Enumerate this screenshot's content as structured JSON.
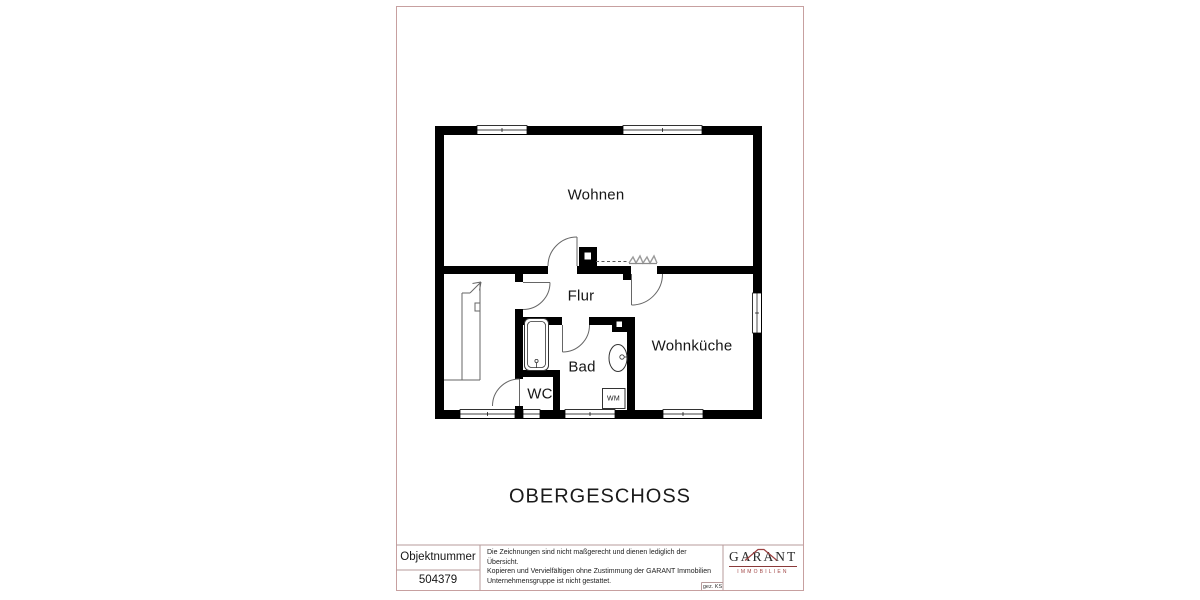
{
  "page": {
    "background": "#ffffff",
    "sheet_border_color": "#c7a0a0",
    "wall_color": "#000000"
  },
  "floor_plan": {
    "rooms": [
      {
        "label": "Wohnen"
      },
      {
        "label": "Flur"
      },
      {
        "label": "Bad"
      },
      {
        "label": "WC"
      },
      {
        "label": "Wohnküche"
      }
    ],
    "appliance_label": "WM"
  },
  "title": "OBERGESCHOSS",
  "title_block": {
    "object_number_label": "Objektnummer",
    "object_number_value": "504379",
    "disclaimer_lines": [
      "Die Zeichnungen sind nicht maßgerecht und dienen lediglich der Übersicht.",
      "Kopieren und Vervielfältigen ohne Zustimmung der GARANT Immobilien",
      "Unternehmensgruppe ist nicht gestattet."
    ],
    "signed_label": "gez. KS",
    "logo": {
      "name": "GARANT",
      "subtitle": "IMMOBILIEN",
      "accent_color": "#9c4040"
    }
  }
}
